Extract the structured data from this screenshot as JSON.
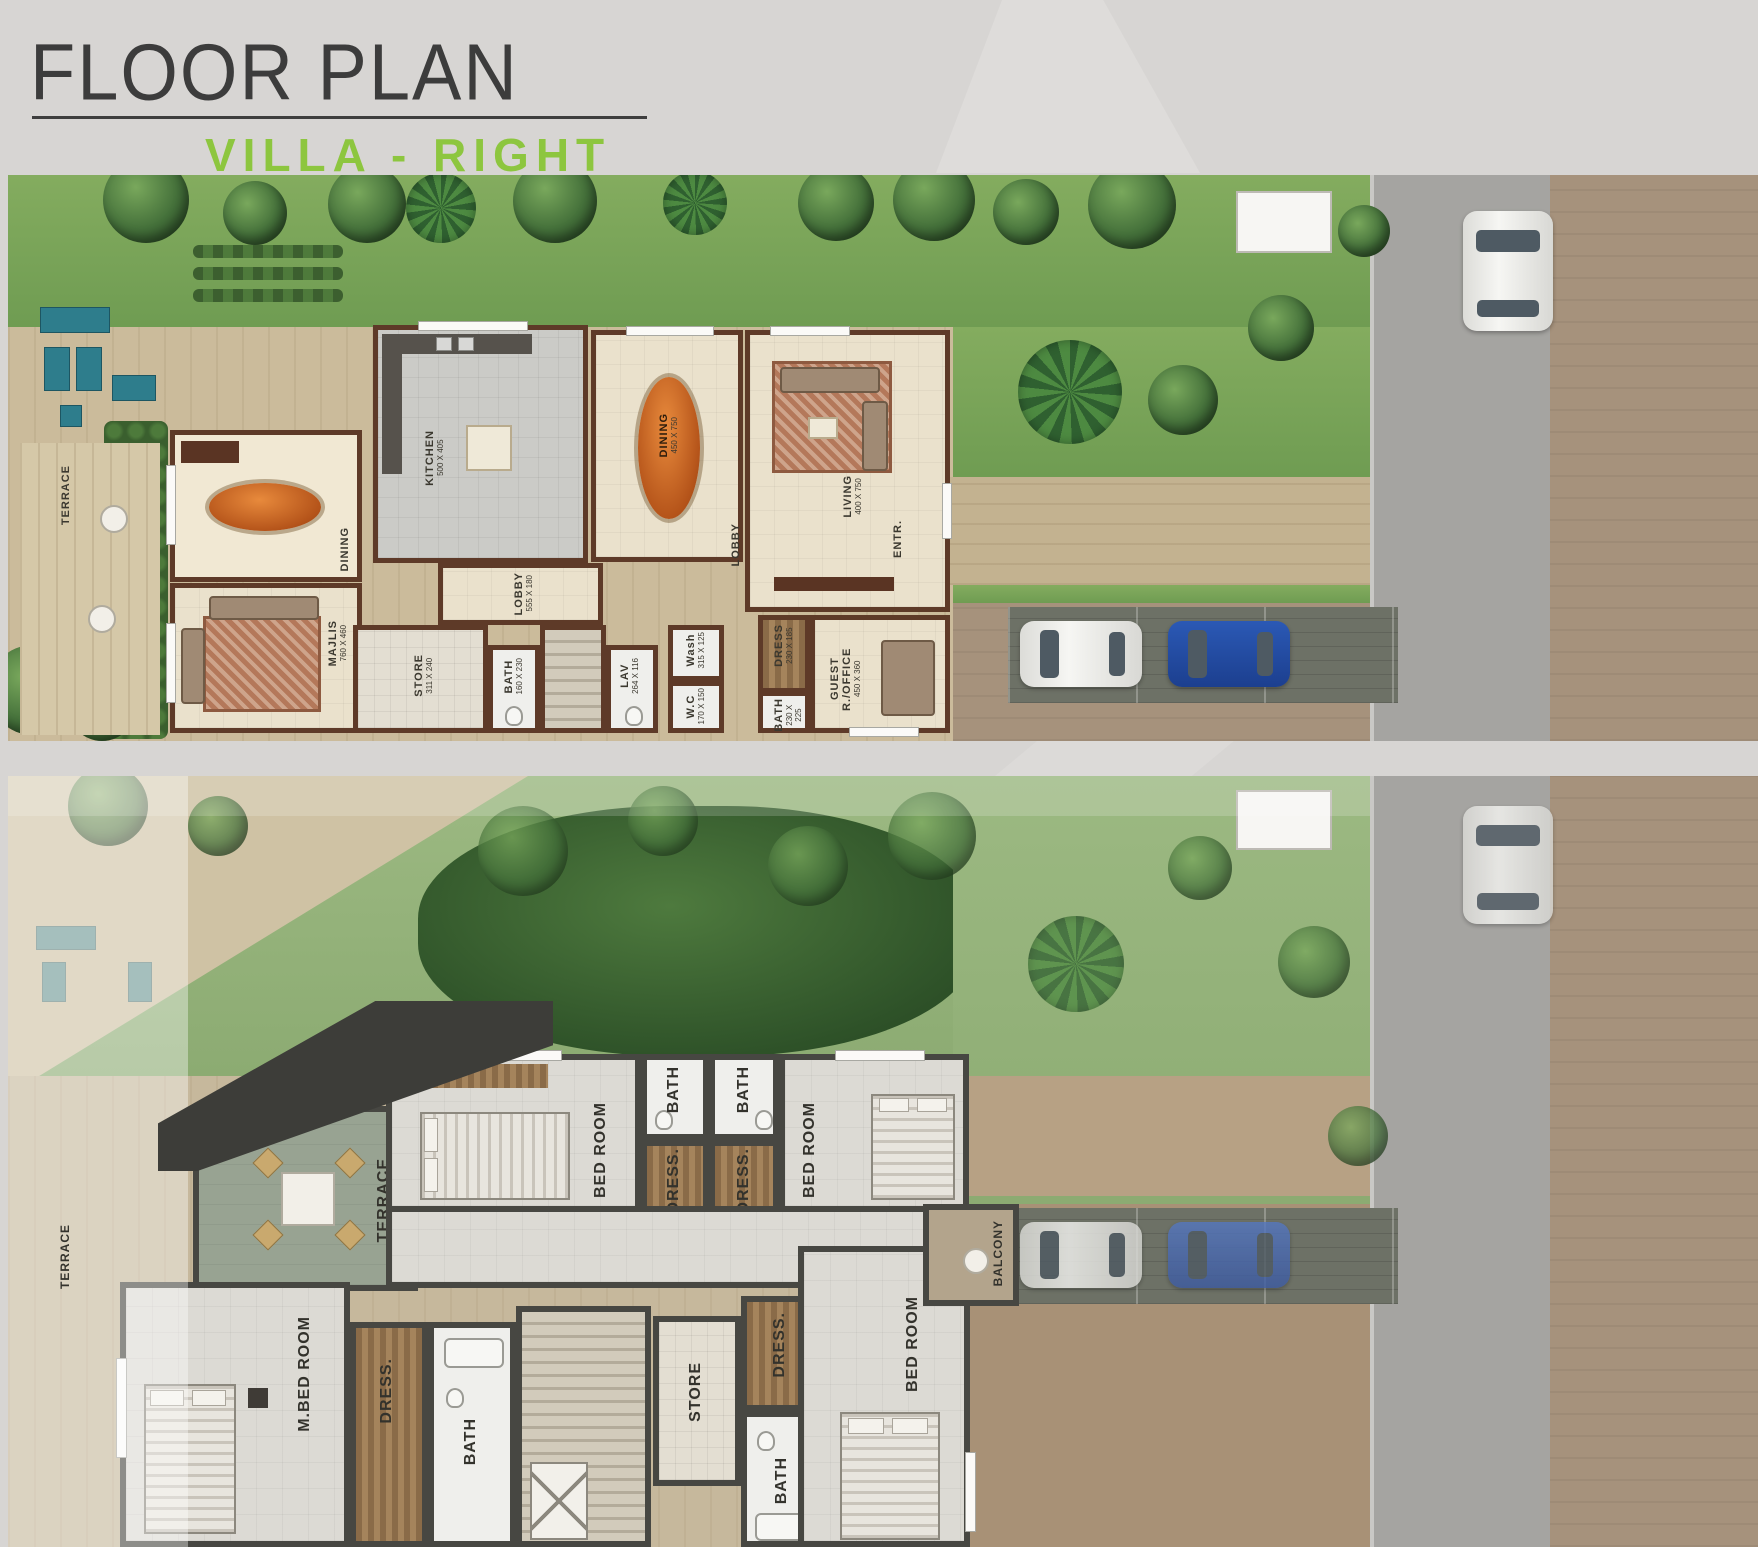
{
  "header": {
    "title": "FLOOR PLAN",
    "subtitle": "VILLA - RIGHT"
  },
  "colors": {
    "accent": "#8dc63f",
    "gf_wall": "#5e3a28",
    "ff_wall": "#474742",
    "grass": "#7ba55b"
  },
  "gf": {
    "rooms": {
      "terrace": {
        "label": "TERRACE"
      },
      "dining_left": {
        "label": "DINING"
      },
      "majlis": {
        "label": "MAJLIS",
        "dim": "760 X 460"
      },
      "kitchen": {
        "label": "KITCHEN",
        "dim": "500 X 405"
      },
      "dining": {
        "label": "DINING",
        "dim": "450 X 750"
      },
      "living": {
        "label": "LIVING",
        "dim": "400 X 750"
      },
      "lobby": {
        "label": "LOBBY",
        "dim": "555 X 180"
      },
      "lobby2": {
        "label": "LOBBY"
      },
      "entr": {
        "label": "ENTR."
      },
      "store": {
        "label": "STORE",
        "dim": "311 X 240"
      },
      "bath1": {
        "label": "BATH",
        "dim": "160 X 230"
      },
      "lav": {
        "label": "LAV",
        "dim": "264 X 116"
      },
      "wash": {
        "label": "Wash",
        "dim": "315 X 125"
      },
      "wc": {
        "label": "W.C",
        "dim": "170 X 150"
      },
      "dress": {
        "label": "DRESS",
        "dim": "230 X 185"
      },
      "bath2": {
        "label": "BATH",
        "dim": "230 X 225"
      },
      "guest": {
        "label": "GUEST R./OFFICE",
        "dim": "450 X 360"
      }
    }
  },
  "ff": {
    "rooms": {
      "terrace_garden": {
        "label": "TERRACE"
      },
      "terrace": {
        "label": "TERRACE"
      },
      "bedroom_tl": {
        "label": "BED ROOM"
      },
      "bath_tl": {
        "label": "BATH"
      },
      "bath_tr": {
        "label": "BATH"
      },
      "dress_tl": {
        "label": "DRESS."
      },
      "dress_tr": {
        "label": "DRESS."
      },
      "bedroom_tr": {
        "label": "BED ROOM"
      },
      "m_bedroom": {
        "label": "M.BED ROOM"
      },
      "dress_m": {
        "label": "DRESS."
      },
      "bath_m": {
        "label": "BATH"
      },
      "store": {
        "label": "STORE"
      },
      "dress_b": {
        "label": "DRESS."
      },
      "bath_b": {
        "label": "BATH"
      },
      "bedroom_br": {
        "label": "BED ROOM"
      },
      "balcony": {
        "label": "BALCONY"
      }
    }
  }
}
